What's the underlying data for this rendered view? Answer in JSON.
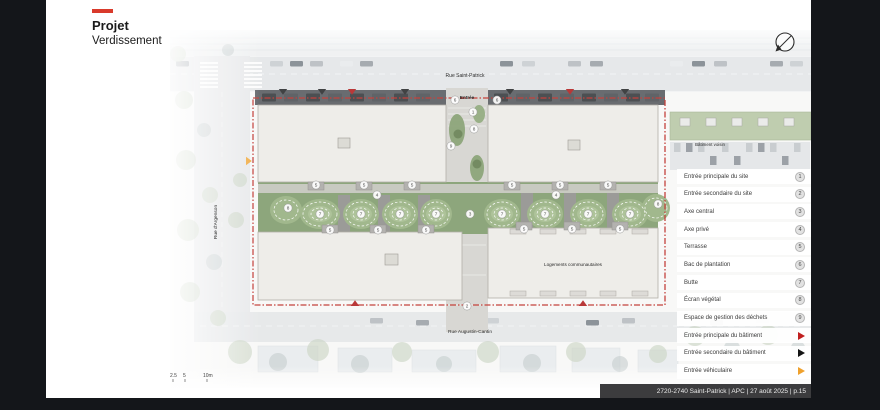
{
  "slide": {
    "title": "Projet",
    "subtitle": "Verdissement",
    "footer": "2720-2740 Saint-Patrick | APC | 27 août 2025 | p.15"
  },
  "plan": {
    "labels": {
      "street_top": "Rue Saint-Patrick",
      "street_bottom": "Rue Augustin-Cantin",
      "street_left": "Rue d'Argenson",
      "entrance": "Entrée",
      "neighbor_building": "Bâtiment voisin",
      "community_housing": "Logements communautaires"
    },
    "scale": {
      "t1": "2.5",
      "t2": "5",
      "t3": "10m"
    },
    "badges": [
      {
        "n": "6",
        "x": 285,
        "y": 70
      },
      {
        "n": "6",
        "x": 327,
        "y": 70
      },
      {
        "n": "1",
        "x": 303,
        "y": 82
      },
      {
        "n": "8",
        "x": 304,
        "y": 99
      },
      {
        "n": "9",
        "x": 281,
        "y": 116
      },
      {
        "n": "3",
        "x": 300,
        "y": 184
      },
      {
        "n": "2",
        "x": 297,
        "y": 276
      },
      {
        "n": "4",
        "x": 207,
        "y": 165
      },
      {
        "n": "4",
        "x": 386,
        "y": 165
      },
      {
        "n": "8",
        "x": 118,
        "y": 178
      },
      {
        "n": "8",
        "x": 488,
        "y": 174
      },
      {
        "n": "7",
        "x": 150,
        "y": 184
      },
      {
        "n": "7",
        "x": 191,
        "y": 184
      },
      {
        "n": "7",
        "x": 230,
        "y": 184
      },
      {
        "n": "7",
        "x": 266,
        "y": 184
      },
      {
        "n": "7",
        "x": 332,
        "y": 184
      },
      {
        "n": "7",
        "x": 375,
        "y": 184
      },
      {
        "n": "7",
        "x": 418,
        "y": 184
      },
      {
        "n": "7",
        "x": 460,
        "y": 184
      },
      {
        "n": "5",
        "x": 146,
        "y": 155
      },
      {
        "n": "5",
        "x": 194,
        "y": 155
      },
      {
        "n": "5",
        "x": 242,
        "y": 155
      },
      {
        "n": "5",
        "x": 342,
        "y": 155
      },
      {
        "n": "5",
        "x": 390,
        "y": 155
      },
      {
        "n": "5",
        "x": 438,
        "y": 155
      },
      {
        "n": "5",
        "x": 160,
        "y": 200
      },
      {
        "n": "5",
        "x": 208,
        "y": 200
      },
      {
        "n": "5",
        "x": 256,
        "y": 200
      },
      {
        "n": "5",
        "x": 354,
        "y": 199
      },
      {
        "n": "5",
        "x": 402,
        "y": 199
      },
      {
        "n": "5",
        "x": 450,
        "y": 199
      }
    ],
    "triangles": [
      {
        "c": "#26282a",
        "x": 113,
        "y": 59,
        "dir": "down"
      },
      {
        "c": "#26282a",
        "x": 152,
        "y": 59,
        "dir": "down"
      },
      {
        "c": "#b01d1d",
        "x": 182,
        "y": 59,
        "dir": "down"
      },
      {
        "c": "#26282a",
        "x": 235,
        "y": 59,
        "dir": "down"
      },
      {
        "c": "#26282a",
        "x": 340,
        "y": 59,
        "dir": "down"
      },
      {
        "c": "#b01d1d",
        "x": 400,
        "y": 59,
        "dir": "down"
      },
      {
        "c": "#26282a",
        "x": 455,
        "y": 59,
        "dir": "down"
      },
      {
        "c": "#b01d1d",
        "x": 185,
        "y": 276,
        "dir": "up"
      },
      {
        "c": "#b01d1d",
        "x": 413,
        "y": 276,
        "dir": "up"
      },
      {
        "c": "#efa12d",
        "x": 76,
        "y": 131,
        "dir": "right"
      }
    ]
  },
  "legend": {
    "items": [
      {
        "label": "Entrée principale du site",
        "badge": "1"
      },
      {
        "label": "Entrée secondaire du site",
        "badge": "2"
      },
      {
        "label": "Axe central",
        "badge": "3"
      },
      {
        "label": "Axe privé",
        "badge": "4"
      },
      {
        "label": "Terrasse",
        "badge": "5"
      },
      {
        "label": "Bac de plantation",
        "badge": "6"
      },
      {
        "label": "Butte",
        "badge": "7"
      },
      {
        "label": "Écran végétal",
        "badge": "8"
      },
      {
        "label": "Espace de gestion des déchets",
        "badge": "9"
      },
      {
        "label": "Entrée principale du bâtiment",
        "arrow": "#c01f1f"
      },
      {
        "label": "Entrée secondaire du bâtiment",
        "arrow": "#141414"
      },
      {
        "label": "Entrée véhiculaire",
        "arrow": "#efa12d"
      }
    ]
  },
  "colors": {
    "accent_red": "#d93a2b",
    "boundary_red": "#bc2823",
    "arrow_red": "#c01f1f",
    "arrow_black": "#141414",
    "arrow_orange": "#efa12d",
    "background_black": "#14161a"
  }
}
